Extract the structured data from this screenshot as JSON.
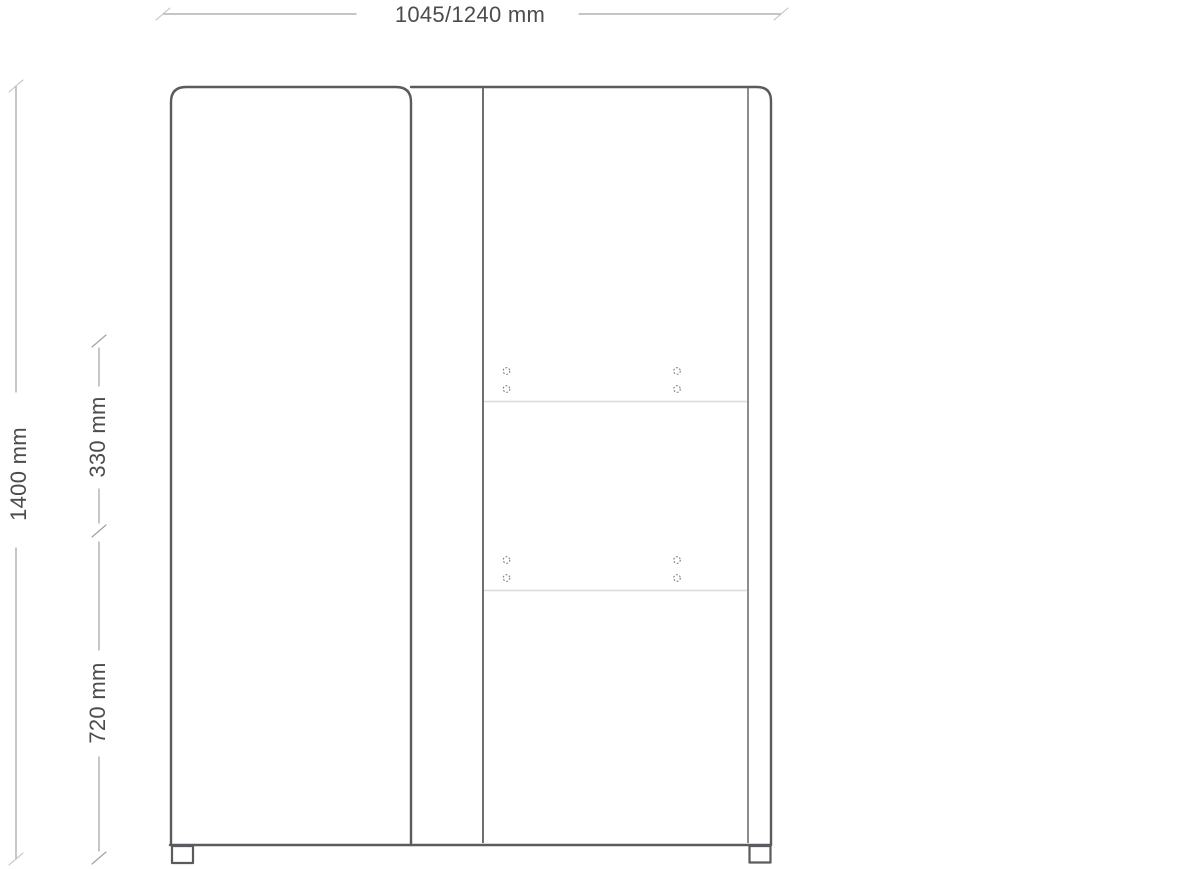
{
  "diagram": {
    "type": "furniture-dimension-drawing",
    "subject": "two-door wardrobe front elevation with wall-mount hole positions",
    "labels": {
      "width": "1045/1240 mm",
      "total_height": "1400 mm",
      "mount_spacing": "330 mm",
      "lower_height": "720 mm"
    },
    "colors": {
      "background": "#ffffff",
      "outline": "#5a5b5e",
      "inner_line": "#6e6f72",
      "dimension_line": "#a2a2a3",
      "faint_tick": "#bfbfbf",
      "faint_line": "#dadada",
      "hole_outline": "#7d7d7f",
      "text": "#4c4c4e"
    }
  }
}
